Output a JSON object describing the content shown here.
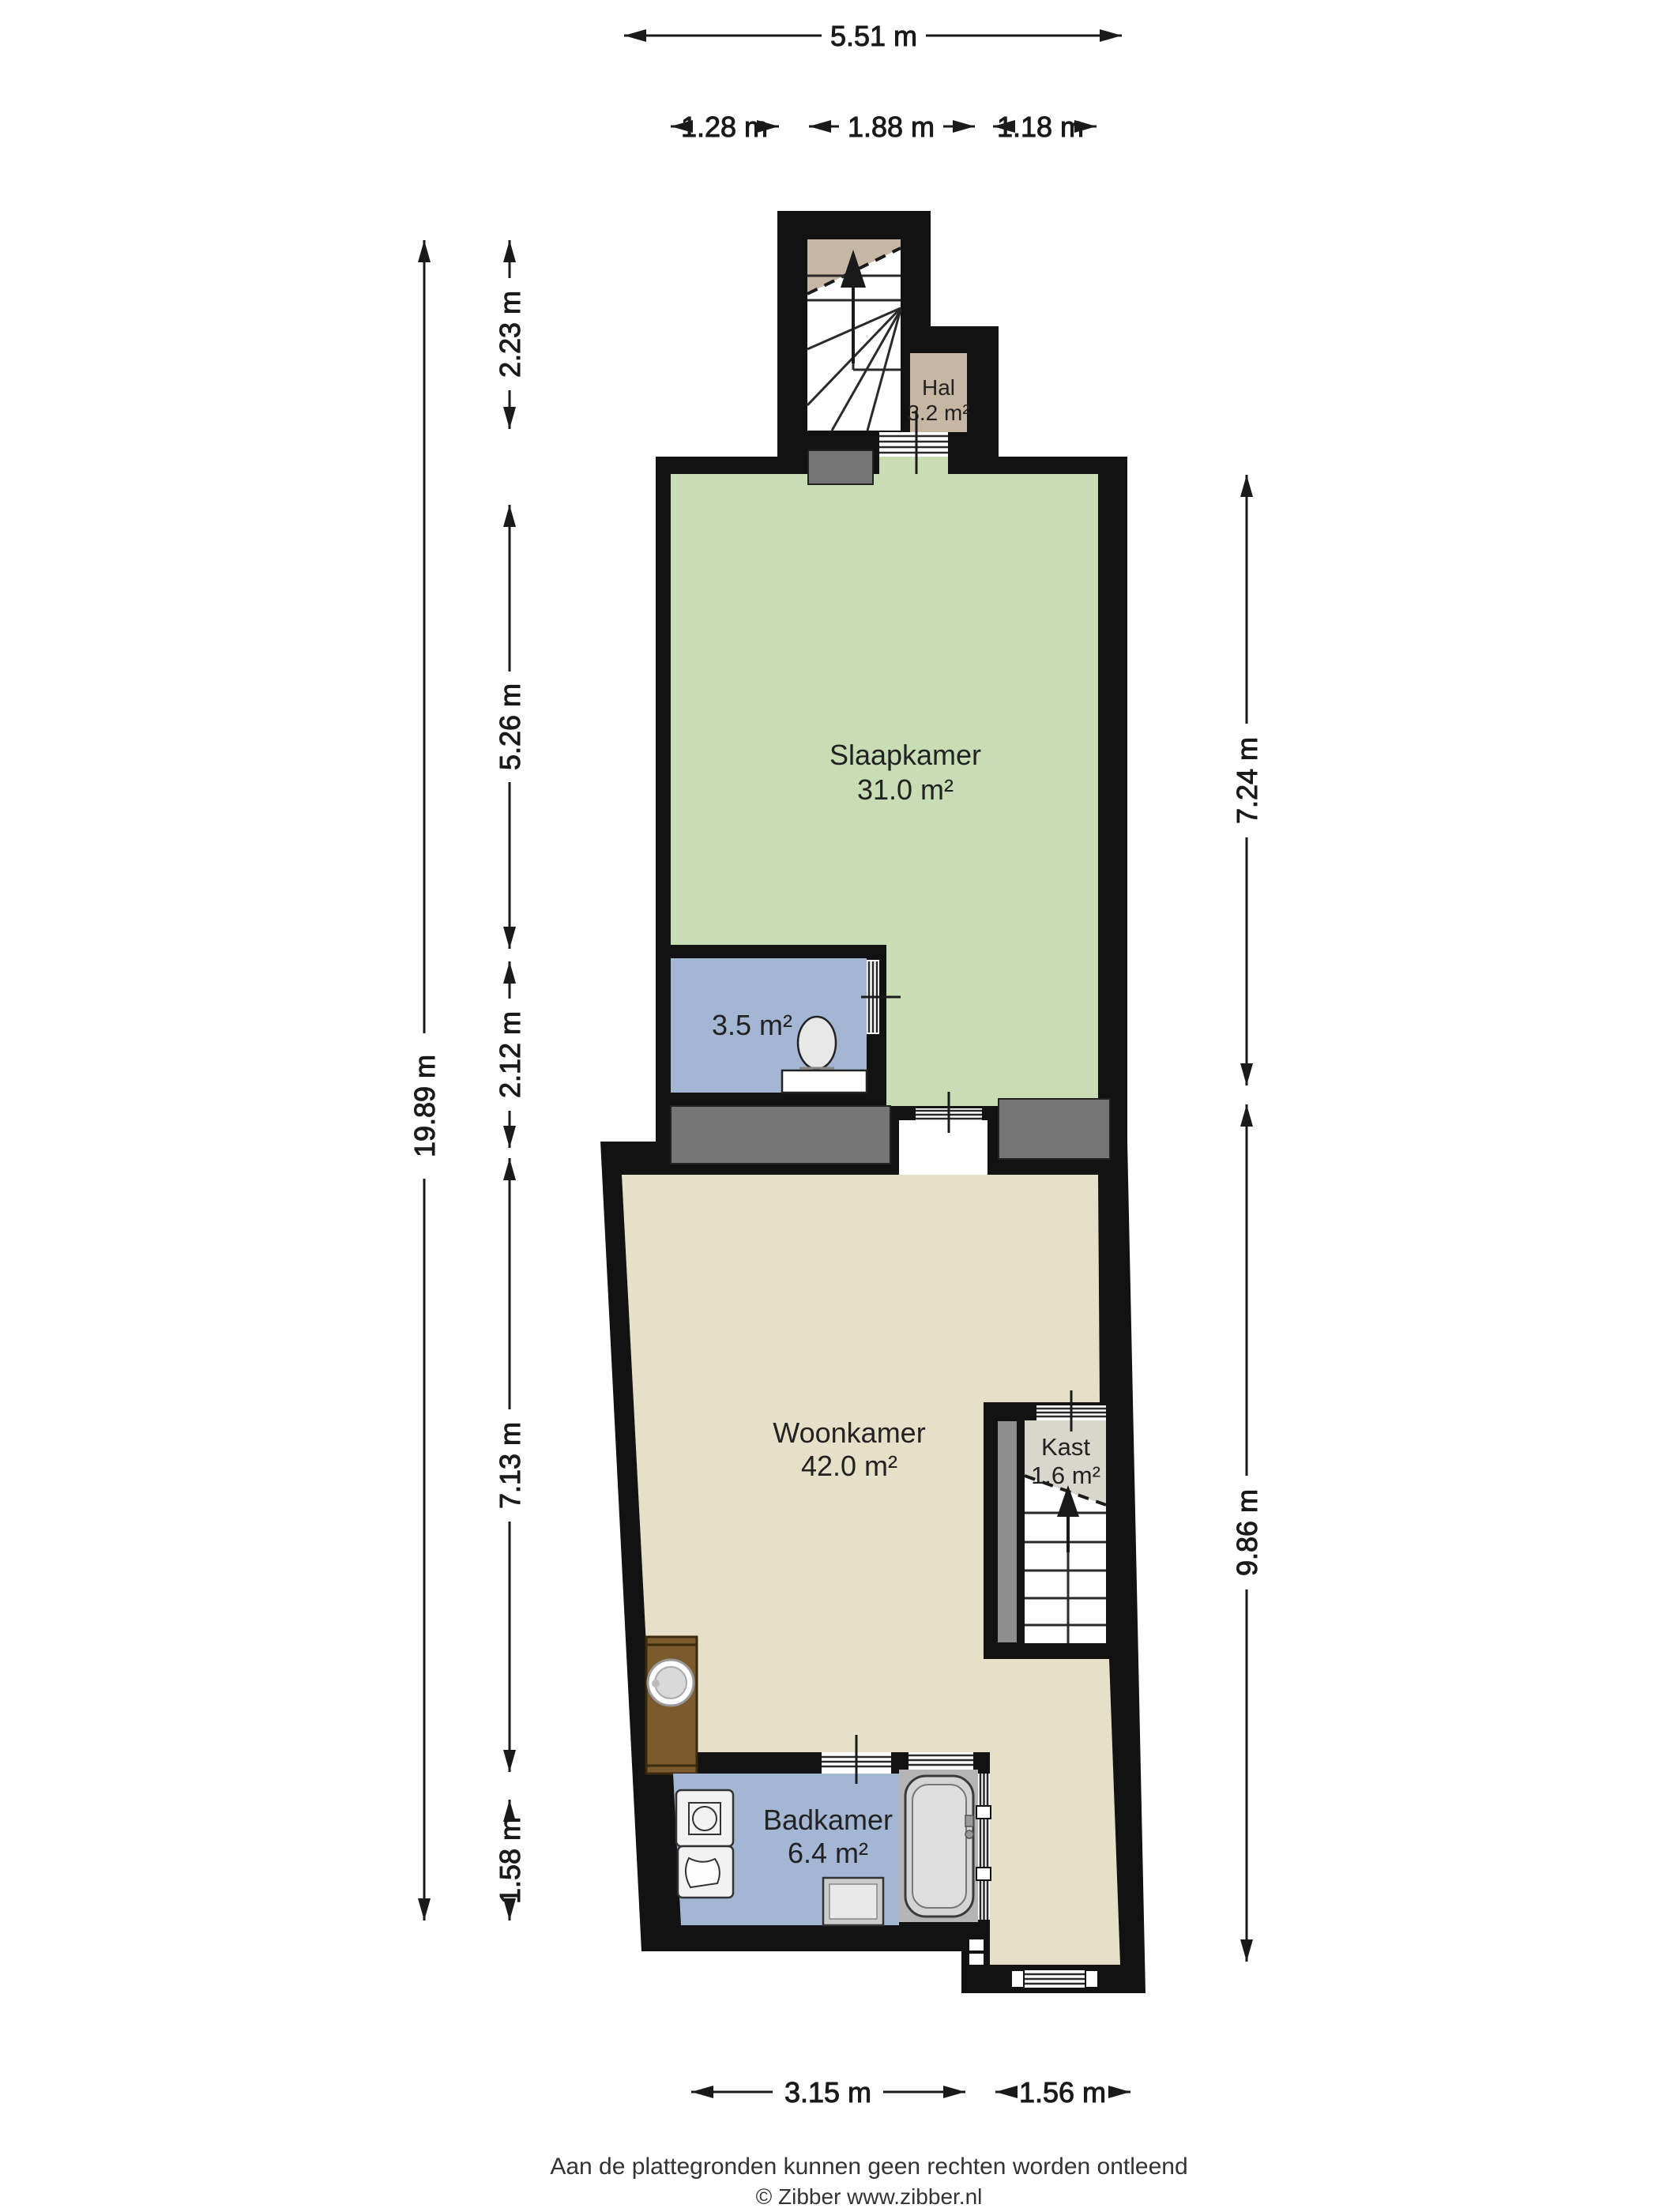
{
  "colors": {
    "wall": "#121212",
    "slaapkamer": "#c8ddb4",
    "woonkamer": "#e6e0c8",
    "hal": "#c6b7a4",
    "wetroom": "#a3b6d3",
    "kast": "#d9d6cb",
    "chimney": "#757575",
    "partition": "#8e8e8e",
    "tub_floor": "#b5b5b5",
    "wood": "#7b5a2e",
    "dim_line": "#1a1a1a"
  },
  "rooms": {
    "hal": {
      "name": "Hal",
      "area": "3.2 m²"
    },
    "slaapkamer": {
      "name": "Slaapkamer",
      "area": "31.0 m²"
    },
    "toilet": {
      "area": "3.5 m²"
    },
    "woonkamer": {
      "name": "Woonkamer",
      "area": "42.0 m²"
    },
    "kast": {
      "name": "Kast",
      "area": "1.6 m²"
    },
    "badkamer": {
      "name": "Badkamer",
      "area": "6.4 m²"
    }
  },
  "dimensions": {
    "top_total": "5.51 m",
    "top_segments": [
      "1.28 m",
      "1.88 m",
      "1.18 m"
    ],
    "left_total": "19.89 m",
    "left_segments": [
      "2.23 m",
      "5.26 m",
      "2.12 m",
      "7.13 m",
      "1.58 m"
    ],
    "right_segments": [
      "7.24 m",
      "9.86 m"
    ],
    "bottom_segments": [
      "3.15 m",
      "1.56 m"
    ]
  },
  "footer": {
    "disclaimer": "Aan de plattegronden kunnen geen rechten worden ontleend",
    "copyright": "© Zibber www.zibber.nl"
  }
}
